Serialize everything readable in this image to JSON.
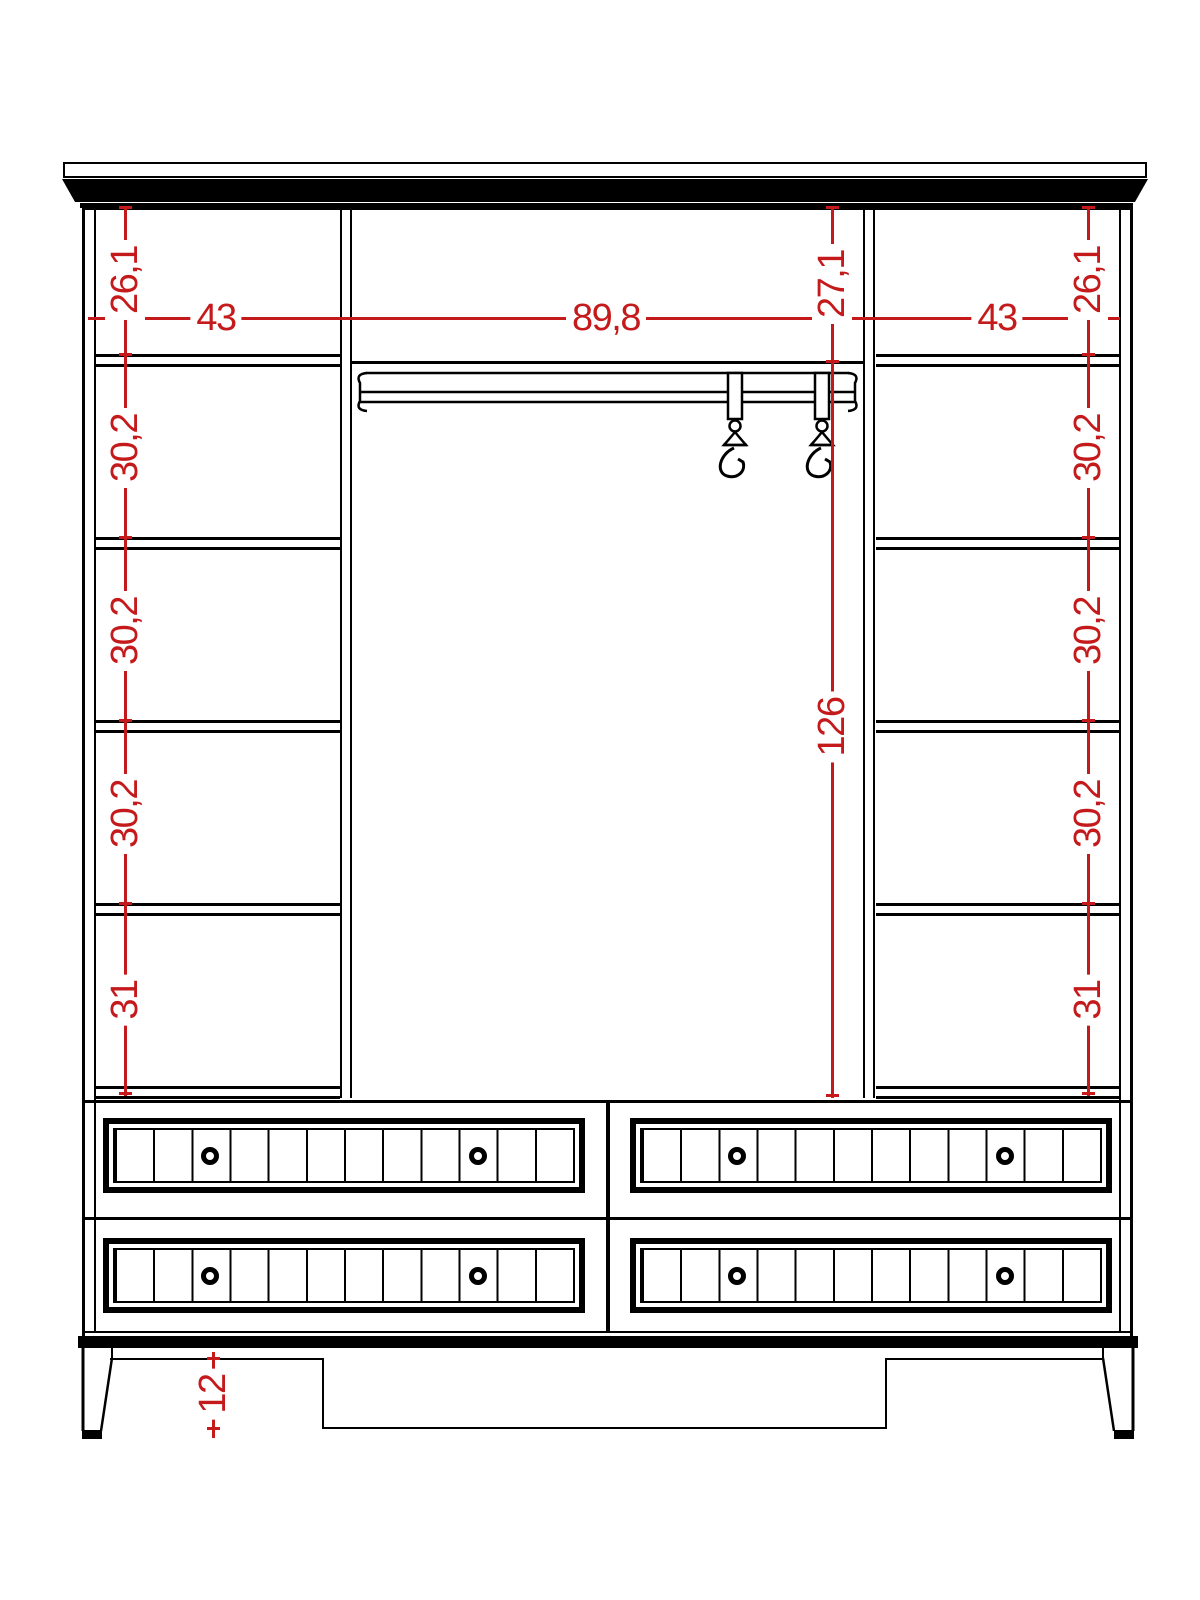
{
  "drawing": {
    "type": "wardrobe-front-elevation",
    "dimension_color": "#c41a1c",
    "line_color": "#000000"
  },
  "dim": {
    "left_heights": [
      "26,1",
      "30,2",
      "30,2",
      "30,2",
      "31"
    ],
    "right_heights": [
      "26,1",
      "30,2",
      "30,2",
      "30,2",
      "31"
    ],
    "top_widths": [
      "43",
      "89,8",
      "43"
    ],
    "center_top_height": "27,1",
    "center_height": "126",
    "leg_height": "12"
  }
}
